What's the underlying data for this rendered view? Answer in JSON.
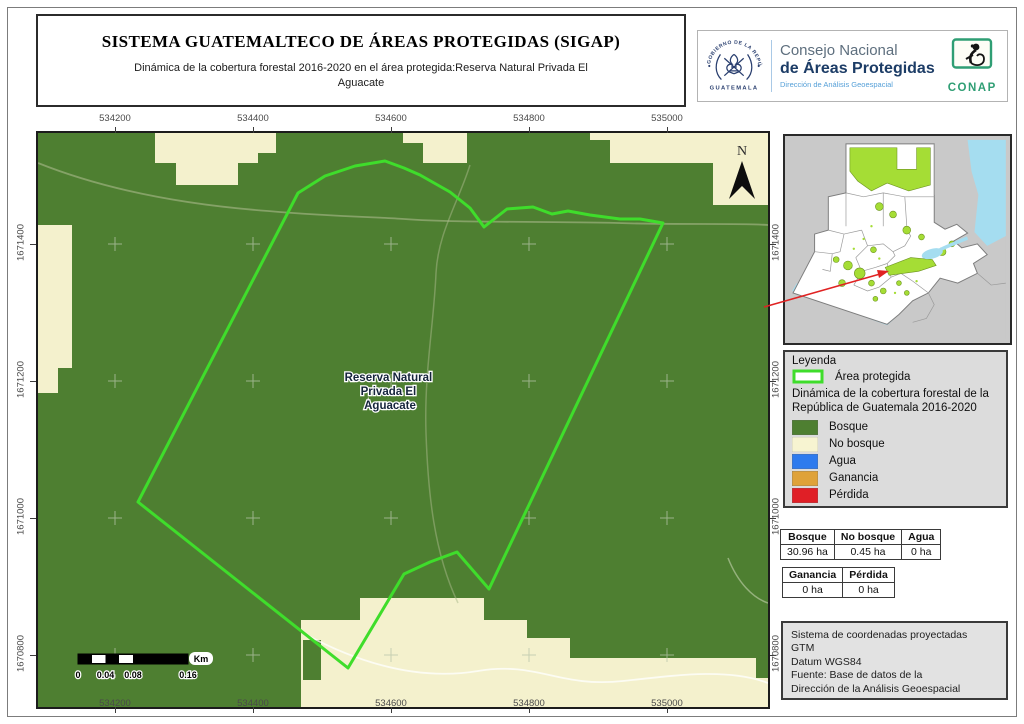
{
  "header": {
    "title": "SISTEMA GUATEMALTECO DE ÁREAS PROTEGIDAS  (SIGAP)",
    "subtitle": "Dinámica de la cobertura forestal 2016-2020 en el área protegida:Reserva Natural Privada El Aguacate",
    "seal_top": "GOBIERNO DE LA REPÚBLICA",
    "seal_bottom": "GUATEMALA",
    "org_line1": "Consejo Nacional",
    "org_line2": "de Áreas Protegidas",
    "org_line3": "Dirección de Análisis Geoespacial",
    "conap": "CONAP"
  },
  "map": {
    "label_lines": [
      "Reserva Natural",
      "Privada El",
      "Aguacate"
    ],
    "north": "N",
    "x_ticks": [
      "534200",
      "534400",
      "534600",
      "534800",
      "535000"
    ],
    "y_ticks": [
      "1671400",
      "1671200",
      "1671000",
      "1670800"
    ],
    "scalebar": {
      "labels": [
        "0",
        "0.04",
        "0.08",
        "0.16"
      ],
      "unit": "Km"
    }
  },
  "legend": {
    "title": "Leyenda",
    "protected_label": "Área protegida",
    "subtitle": "Dinámica de la cobertura forestal de la República de Guatemala 2016-2020",
    "items": [
      {
        "label": "Bosque",
        "color": "#4e7f31"
      },
      {
        "label": "No bosque",
        "color": "#f7f4d1"
      },
      {
        "label": "Agua",
        "color": "#2e7bee"
      },
      {
        "label": "Ganancia",
        "color": "#dfa239"
      },
      {
        "label": "Pérdida",
        "color": "#e01f26"
      }
    ]
  },
  "tables": {
    "coverage": {
      "headers": [
        "Bosque",
        "No bosque",
        "Agua"
      ],
      "values": [
        "30.96 ha",
        "0.45 ha",
        "0 ha"
      ]
    },
    "change": {
      "headers": [
        "Ganancia",
        "Pérdida"
      ],
      "values": [
        "0 ha",
        "0 ha"
      ]
    }
  },
  "info_box": {
    "lines": [
      "Sistema de coordenadas proyectadas",
      "GTM",
      "Datum WGS84",
      "Fuente: Base de datos de la",
      "Dirección de la Análisis Geoespacial"
    ]
  },
  "colors": {
    "forest": "#4e7f31",
    "no_forest": "#f4f1cd",
    "protected_outline": "#3fdd2b",
    "water": "#2e7bee",
    "gain": "#dfa239",
    "loss": "#e01f26",
    "locator_arrow": "#e02222",
    "inset_protected": "#a5dd35"
  }
}
